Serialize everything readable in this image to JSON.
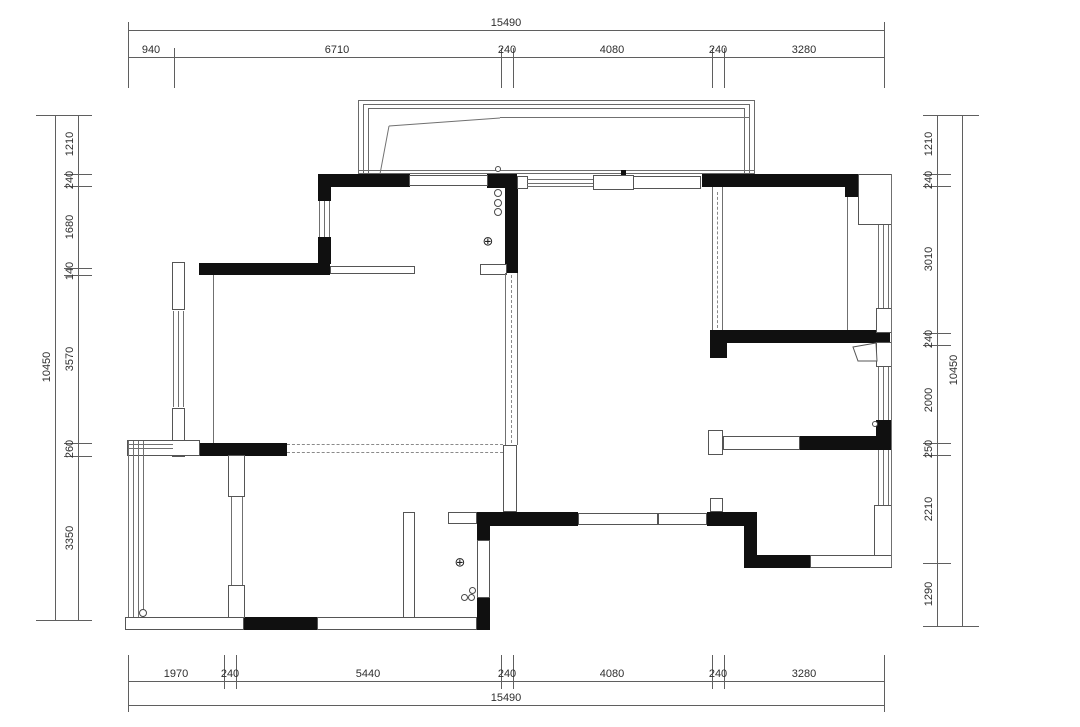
{
  "drawing": {
    "type": "residential floor plan",
    "units": "mm"
  },
  "dims": {
    "top": {
      "total": "15490",
      "segments": [
        "940",
        "6710",
        "240",
        "4080",
        "240",
        "3280"
      ]
    },
    "bottom": {
      "total": "15490",
      "segments": [
        "1970",
        "240",
        "5440",
        "240",
        "4080",
        "240",
        "3280"
      ]
    },
    "left": {
      "total": "10450",
      "segments": [
        "1210",
        "240",
        "1680",
        "140",
        "3570",
        "260",
        "3350"
      ]
    },
    "right": {
      "total": "10450",
      "segments": [
        "1210",
        "240",
        "3010",
        "240",
        "2000",
        "250",
        "2210",
        "1290"
      ]
    }
  },
  "symbols": {
    "floor_drain": "⊕"
  },
  "colors": {
    "wall": "#101010",
    "thin_line": "#707070",
    "dim_text": "#2e2e2e",
    "background": "#ffffff"
  }
}
